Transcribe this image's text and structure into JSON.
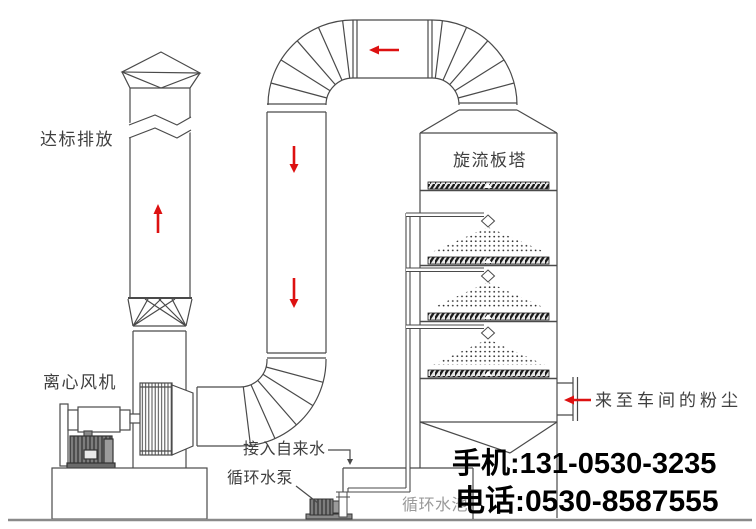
{
  "diagram": {
    "labels": {
      "emission": "达标排放",
      "tower": "旋流板塔",
      "fan": "离心风机",
      "tap_water": "接入自来水",
      "pump": "循环水泵",
      "dust_inlet": "来至车间的粉尘",
      "water_tank": "循环水池"
    },
    "contact": {
      "mobile": "手机:131-0530-3235",
      "phone": "电话:0530-8587555"
    },
    "colors": {
      "line": "#4a4a4a",
      "arrow_red": "#dd1111",
      "label_text": "#3f3f3f",
      "contact_text": "#000000",
      "tank_label_text": "#9a9a9a"
    }
  }
}
